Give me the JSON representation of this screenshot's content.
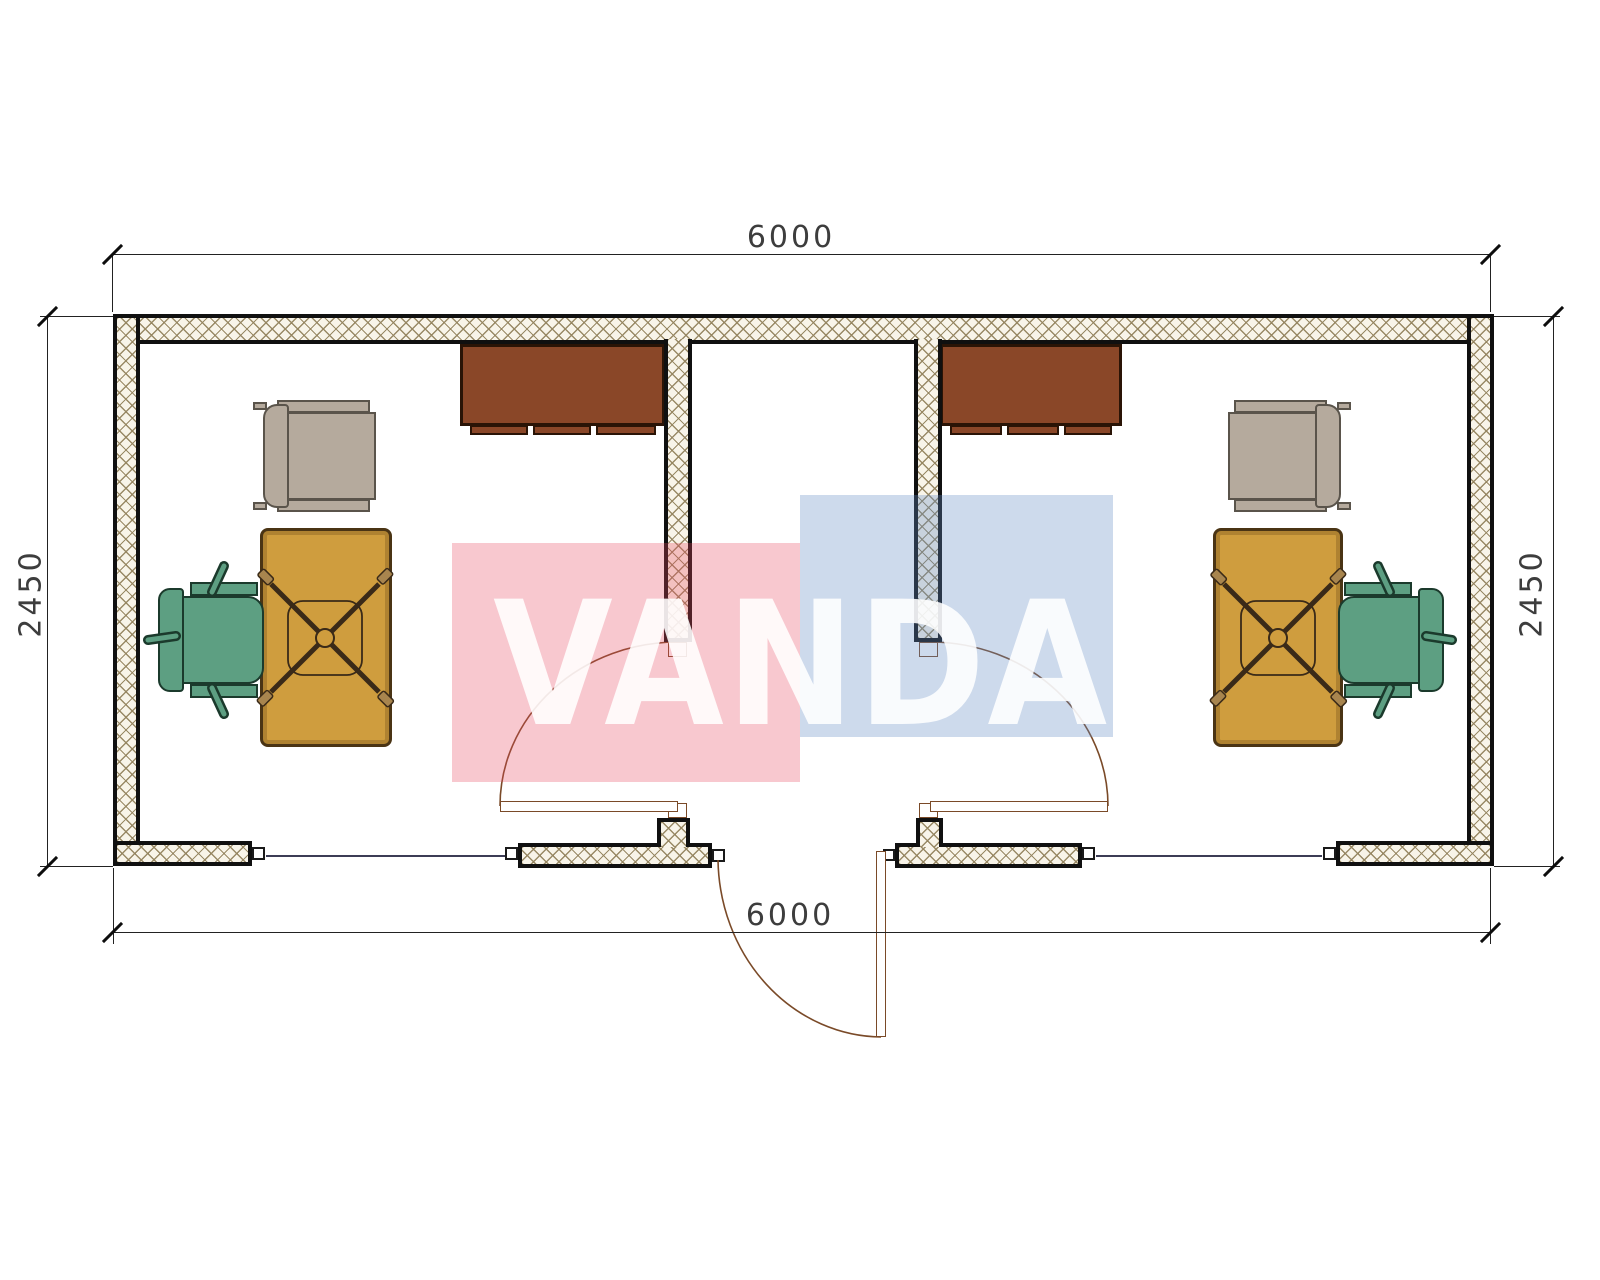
{
  "title": "container-office-floor-plan",
  "watermark": {
    "text": "VANDA",
    "pink_color": "#ee7a8a",
    "blue_color": "#7096c8"
  },
  "dimensions": {
    "top": "6000",
    "bottom": "6000",
    "left": "2450",
    "right": "2450"
  },
  "furniture": {
    "left_room": [
      "wall-cabinet",
      "visitor-chair",
      "desk",
      "office-chair"
    ],
    "right_room": [
      "wall-cabinet",
      "visitor-chair",
      "desk",
      "office-chair"
    ]
  },
  "colors": {
    "cabinet": "#8a4728",
    "desk": "#cf9d3e",
    "office_chair": "#5d9f82",
    "visitor_chair": "#b5aa9d",
    "wall_hatch_line": "#94845f",
    "wall_outline": "#101010",
    "door_arc": "#7a4a28",
    "window_line": "#3c3c55",
    "watermark_pink": "#ee7a8a",
    "watermark_blue": "#7096c8"
  }
}
